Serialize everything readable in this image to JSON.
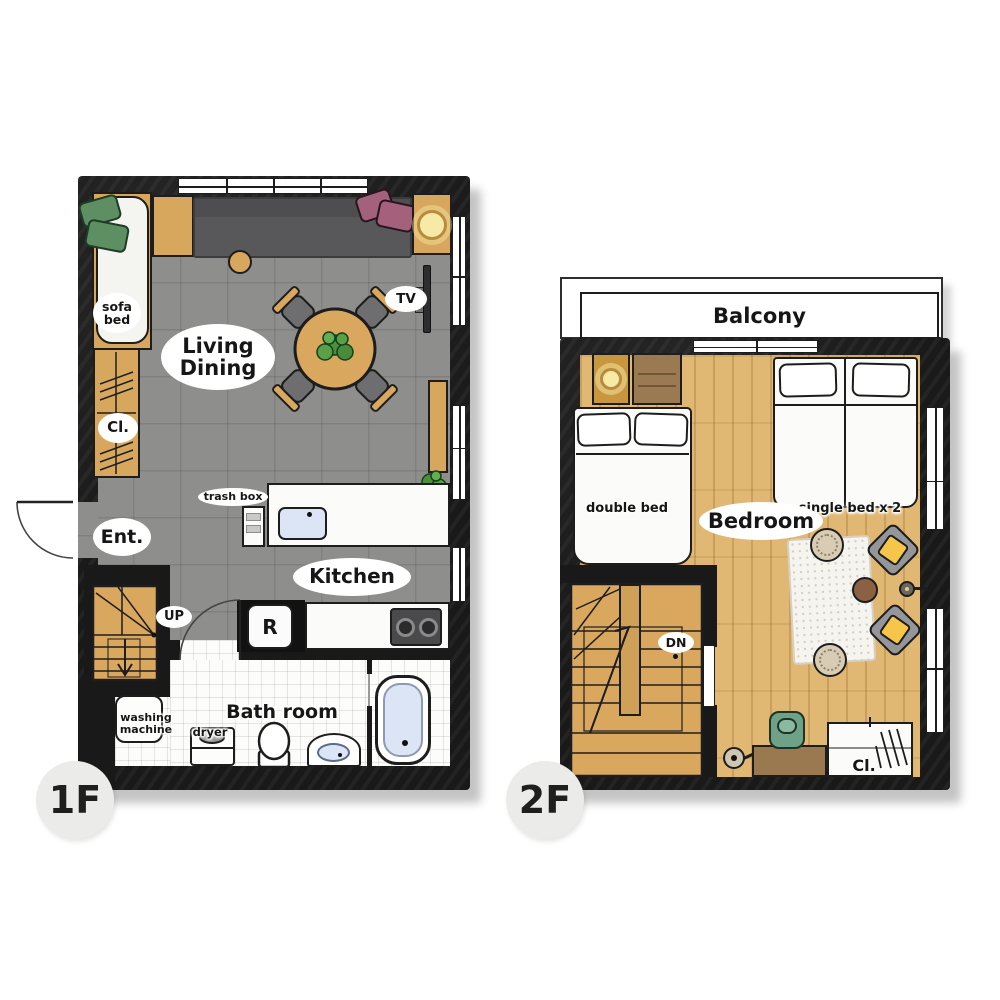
{
  "floor1": {
    "badge": "1F",
    "rooms": {
      "living_dining": "Living\nDining",
      "kitchen": "Kitchen",
      "bathroom": "Bath room",
      "entrance": "Ent."
    },
    "items": {
      "sofa_bed": "sofa\nbed",
      "closet": "Cl.",
      "tv": "TV",
      "trash_box": "trash box",
      "up": "UP",
      "fridge": "R",
      "washing_machine": "washing\nmachine",
      "dryer": "dryer"
    }
  },
  "floor2": {
    "badge": "2F",
    "rooms": {
      "balcony": "Balcony",
      "bedroom": "Bedroom"
    },
    "items": {
      "double_bed": "double bed",
      "single_bed": "single bed x 2",
      "down": "DN",
      "closet": "Cl."
    }
  },
  "colors": {
    "wall": "#191919",
    "tile_floor": "#8e8e8c",
    "wood_floor": "#e1b873",
    "wood_furniture": "#d8a75e",
    "sofa_gray": "#58585a",
    "green_pillow": "#5d8f63",
    "purple_pillow": "#a4617c",
    "yellow_cushion": "#f6c64a",
    "water_blue": "#dbe5f5",
    "lamp_glow": "#f7e9a6",
    "badge_bg": "#ebebe9"
  }
}
